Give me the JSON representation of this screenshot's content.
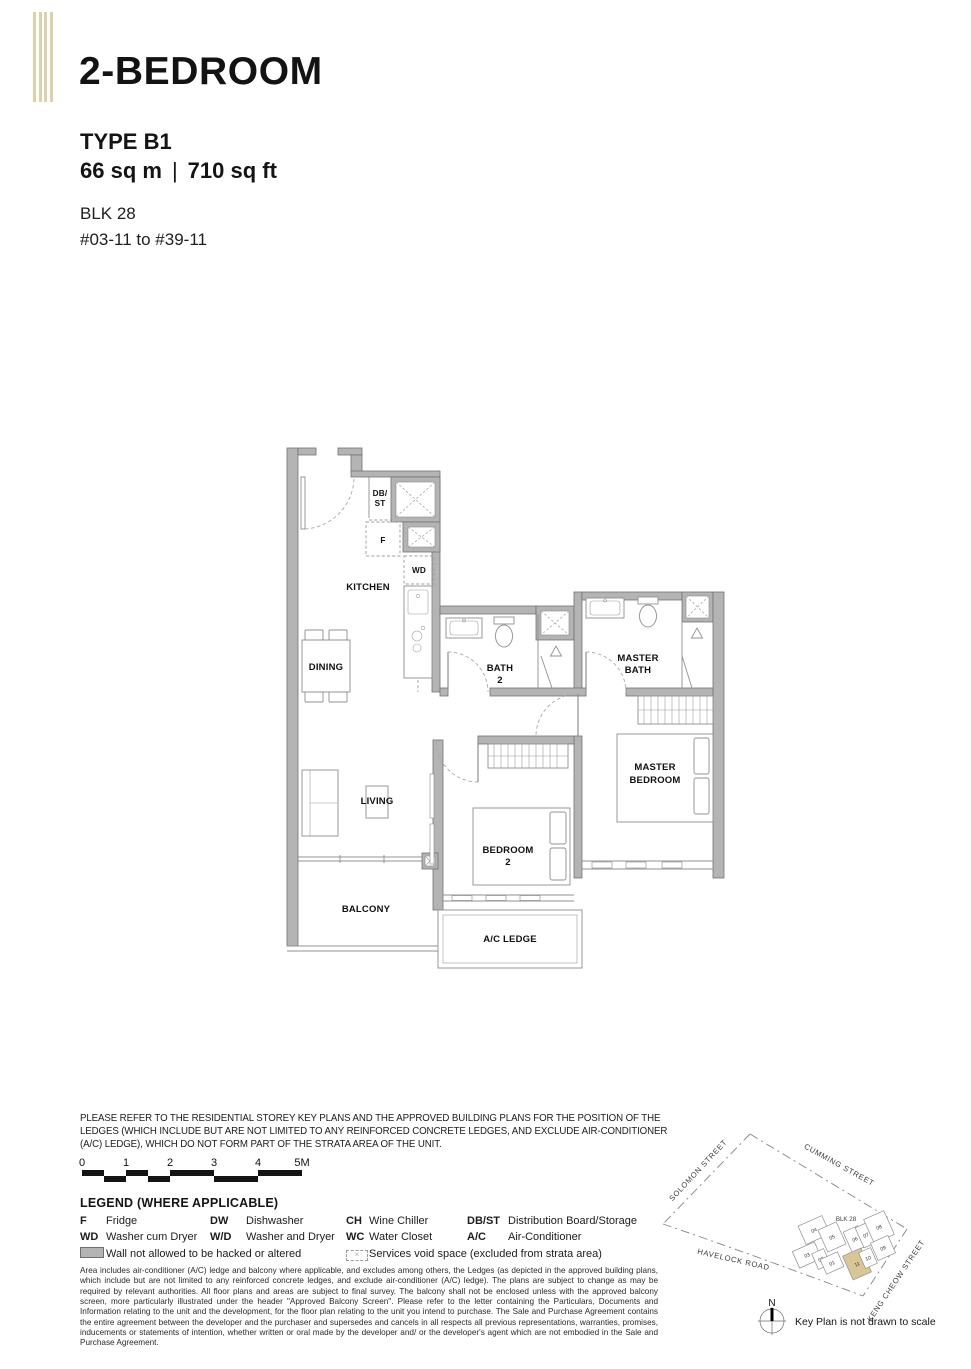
{
  "header": {
    "title": "2-BEDROOM",
    "type": "TYPE B1",
    "area_sqm": "66 sq m",
    "divider": "|",
    "area_sqft": "710 sq ft",
    "block": "BLK 28",
    "unit_range": "#03-11 to #39-11"
  },
  "floorplan": {
    "labels": {
      "db1": "DB/",
      "db2": "ST",
      "fridge": "F",
      "wd": "WD",
      "kitchen": "KITCHEN",
      "dining": "DINING",
      "living": "LIVING",
      "balcony": "BALCONY",
      "ac_ledge": "A/C LEDGE",
      "bath2_line1": "BATH",
      "bath2_line2": "2",
      "mbath_line1": "MASTER",
      "mbath_line2": "BATH",
      "mbr_line1": "MASTER",
      "mbr_line2": "BEDROOM",
      "br2_line1": "BEDROOM",
      "br2_line2": "2"
    }
  },
  "disclaimer": {
    "line1": "PLEASE REFER TO THE RESIDENTIAL STOREY KEY PLANS AND THE APPROVED BUILDING PLANS FOR THE POSITION OF THE",
    "line2": "LEDGES (WHICH INCLUDE BUT ARE NOT LIMITED TO ANY REINFORCED CONCRETE LEDGES, AND EXCLUDE AIR-CONDITIONER",
    "line3": "(A/C) LEDGE), WHICH DO NOT FORM PART OF THE STRATA AREA OF THE UNIT."
  },
  "scalebar": {
    "t0": "0",
    "t1": "1",
    "t2": "2",
    "t3": "3",
    "t4": "4",
    "t5": "5M"
  },
  "legend": {
    "heading": "LEGEND (WHERE APPLICABLE)",
    "items": [
      {
        "abbr": "F",
        "desc": "Fridge"
      },
      {
        "abbr": "DW",
        "desc": "Dishwasher"
      },
      {
        "abbr": "CH",
        "desc": "Wine Chiller"
      },
      {
        "abbr": "DB/ST",
        "desc": "Distribution Board/Storage"
      },
      {
        "abbr": "WD",
        "desc": "Washer cum Dryer"
      },
      {
        "abbr": "W/D",
        "desc": "Washer and Dryer"
      },
      {
        "abbr": "WC",
        "desc": "Water Closet"
      },
      {
        "abbr": "A/C",
        "desc": "Air-Conditioner"
      }
    ],
    "wall_note": "Wall not allowed to be hacked or altered",
    "services_note": "Services void space (excluded from strata area)",
    "void_mark": "×"
  },
  "fine_print": "Area includes air-conditioner (A/C) ledge and balcony where applicable, and excludes among others, the Ledges (as depicted in the approved building plans, which include but are not limited to any reinforced concrete ledges, and exclude air-conditioner (A/C) ledge). The plans are subject to change as may be required by relevant authorities. All floor plans and areas are subject to final survey. The balcony shall not be enclosed unless with the approved balcony screen, more particularly illustrated under the header \"Approved Balcony Screen\". Please refer to the letter containing the Particulars, Documents and Information relating to the unit and the development, for the floor plan relating to the unit you intend to purchase. The Sale and Purchase Agreement contains the entire agreement between the developer and the purchaser and supersedes and cancels in all respects all previous representations, warranties, promises, inducements or statements of intention, whether written or oral made by the developer and/ or the developer's agent which are not embodied in the Sale and Purchase Agreement.",
  "keyplan": {
    "block_label": "BLK 28",
    "streets": {
      "solomon": "SOLOMON STREET",
      "cumming": "CUMMING STREET",
      "havelock": "HAVELOCK ROAD",
      "keng_cheow": "KENG CHEOW STREET"
    },
    "units": [
      "04",
      "05",
      "06",
      "07",
      "08",
      "03",
      "02",
      "01",
      "11",
      "10",
      "09"
    ],
    "highlighted_unit": "11",
    "highlight_color": "#d9c696",
    "north_label": "N",
    "note": "Key Plan is not drawn to scale"
  },
  "colors": {
    "stripes": "#ddd1a9",
    "wall": "#b4b4b4",
    "highlight": "#d9c696"
  }
}
